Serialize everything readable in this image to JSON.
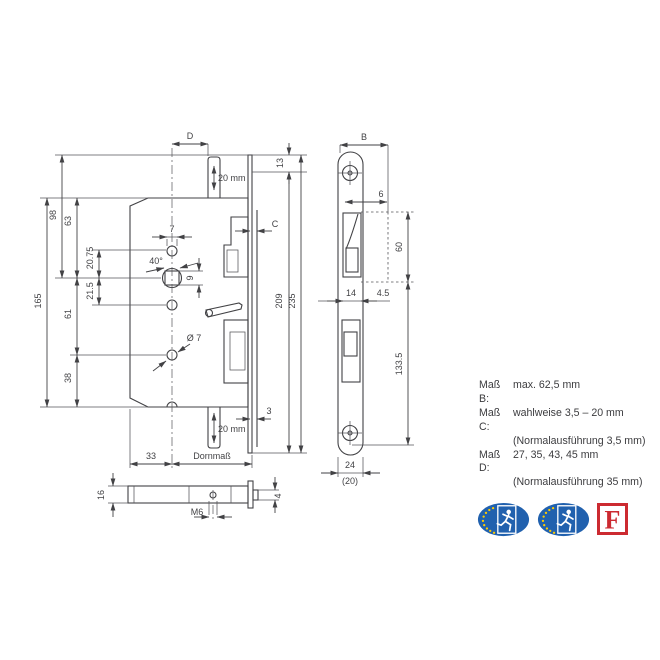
{
  "title": "Einsteckschloss Masszeichnung",
  "colors": {
    "line": "#424245",
    "badge_blue": "#2161ae",
    "star_yellow": "#ffcc00",
    "fire_red": "#cc2a31"
  },
  "front_view": {
    "dims": {
      "D": "D",
      "slot_top": "20 mm",
      "d13": "13",
      "d98": "98",
      "d63": "63",
      "d165": "165",
      "d61": "61",
      "d38": "38",
      "d2075": "20.75",
      "d215": "21.5",
      "d7": "7",
      "angle": "40°",
      "d9": "9",
      "dia7": "Ø 7",
      "C": "C",
      "d209": "209",
      "d235": "235",
      "d3": "3",
      "slot_bottom": "20 mm",
      "d33": "33",
      "dornmass": "Dornmaß"
    }
  },
  "bottom_view": {
    "dims": {
      "d16": "16",
      "m6": "M6",
      "d4": "4"
    }
  },
  "side_view": {
    "dims": {
      "B": "B",
      "d6": "6",
      "d60": "60",
      "d14": "14",
      "d45": "4.5",
      "d1335": "133.5",
      "d24": "24",
      "d20": "(20)"
    }
  },
  "notes": {
    "rows": [
      {
        "label": "Maß B:",
        "text": "max. 62,5 mm"
      },
      {
        "label": "Maß C:",
        "text": "wahlweise 3,5 – 20 mm"
      },
      {
        "label": "",
        "text": "(Normalausführung 3,5 mm)"
      },
      {
        "label": "Maß D:",
        "text": "27, 35, 43, 45 mm"
      },
      {
        "label": "",
        "text": "(Normalausführung 35 mm)"
      }
    ]
  },
  "logos": {
    "emergency_exit_badge": "eu-emergency-exit-badge",
    "fire_label": "F"
  }
}
